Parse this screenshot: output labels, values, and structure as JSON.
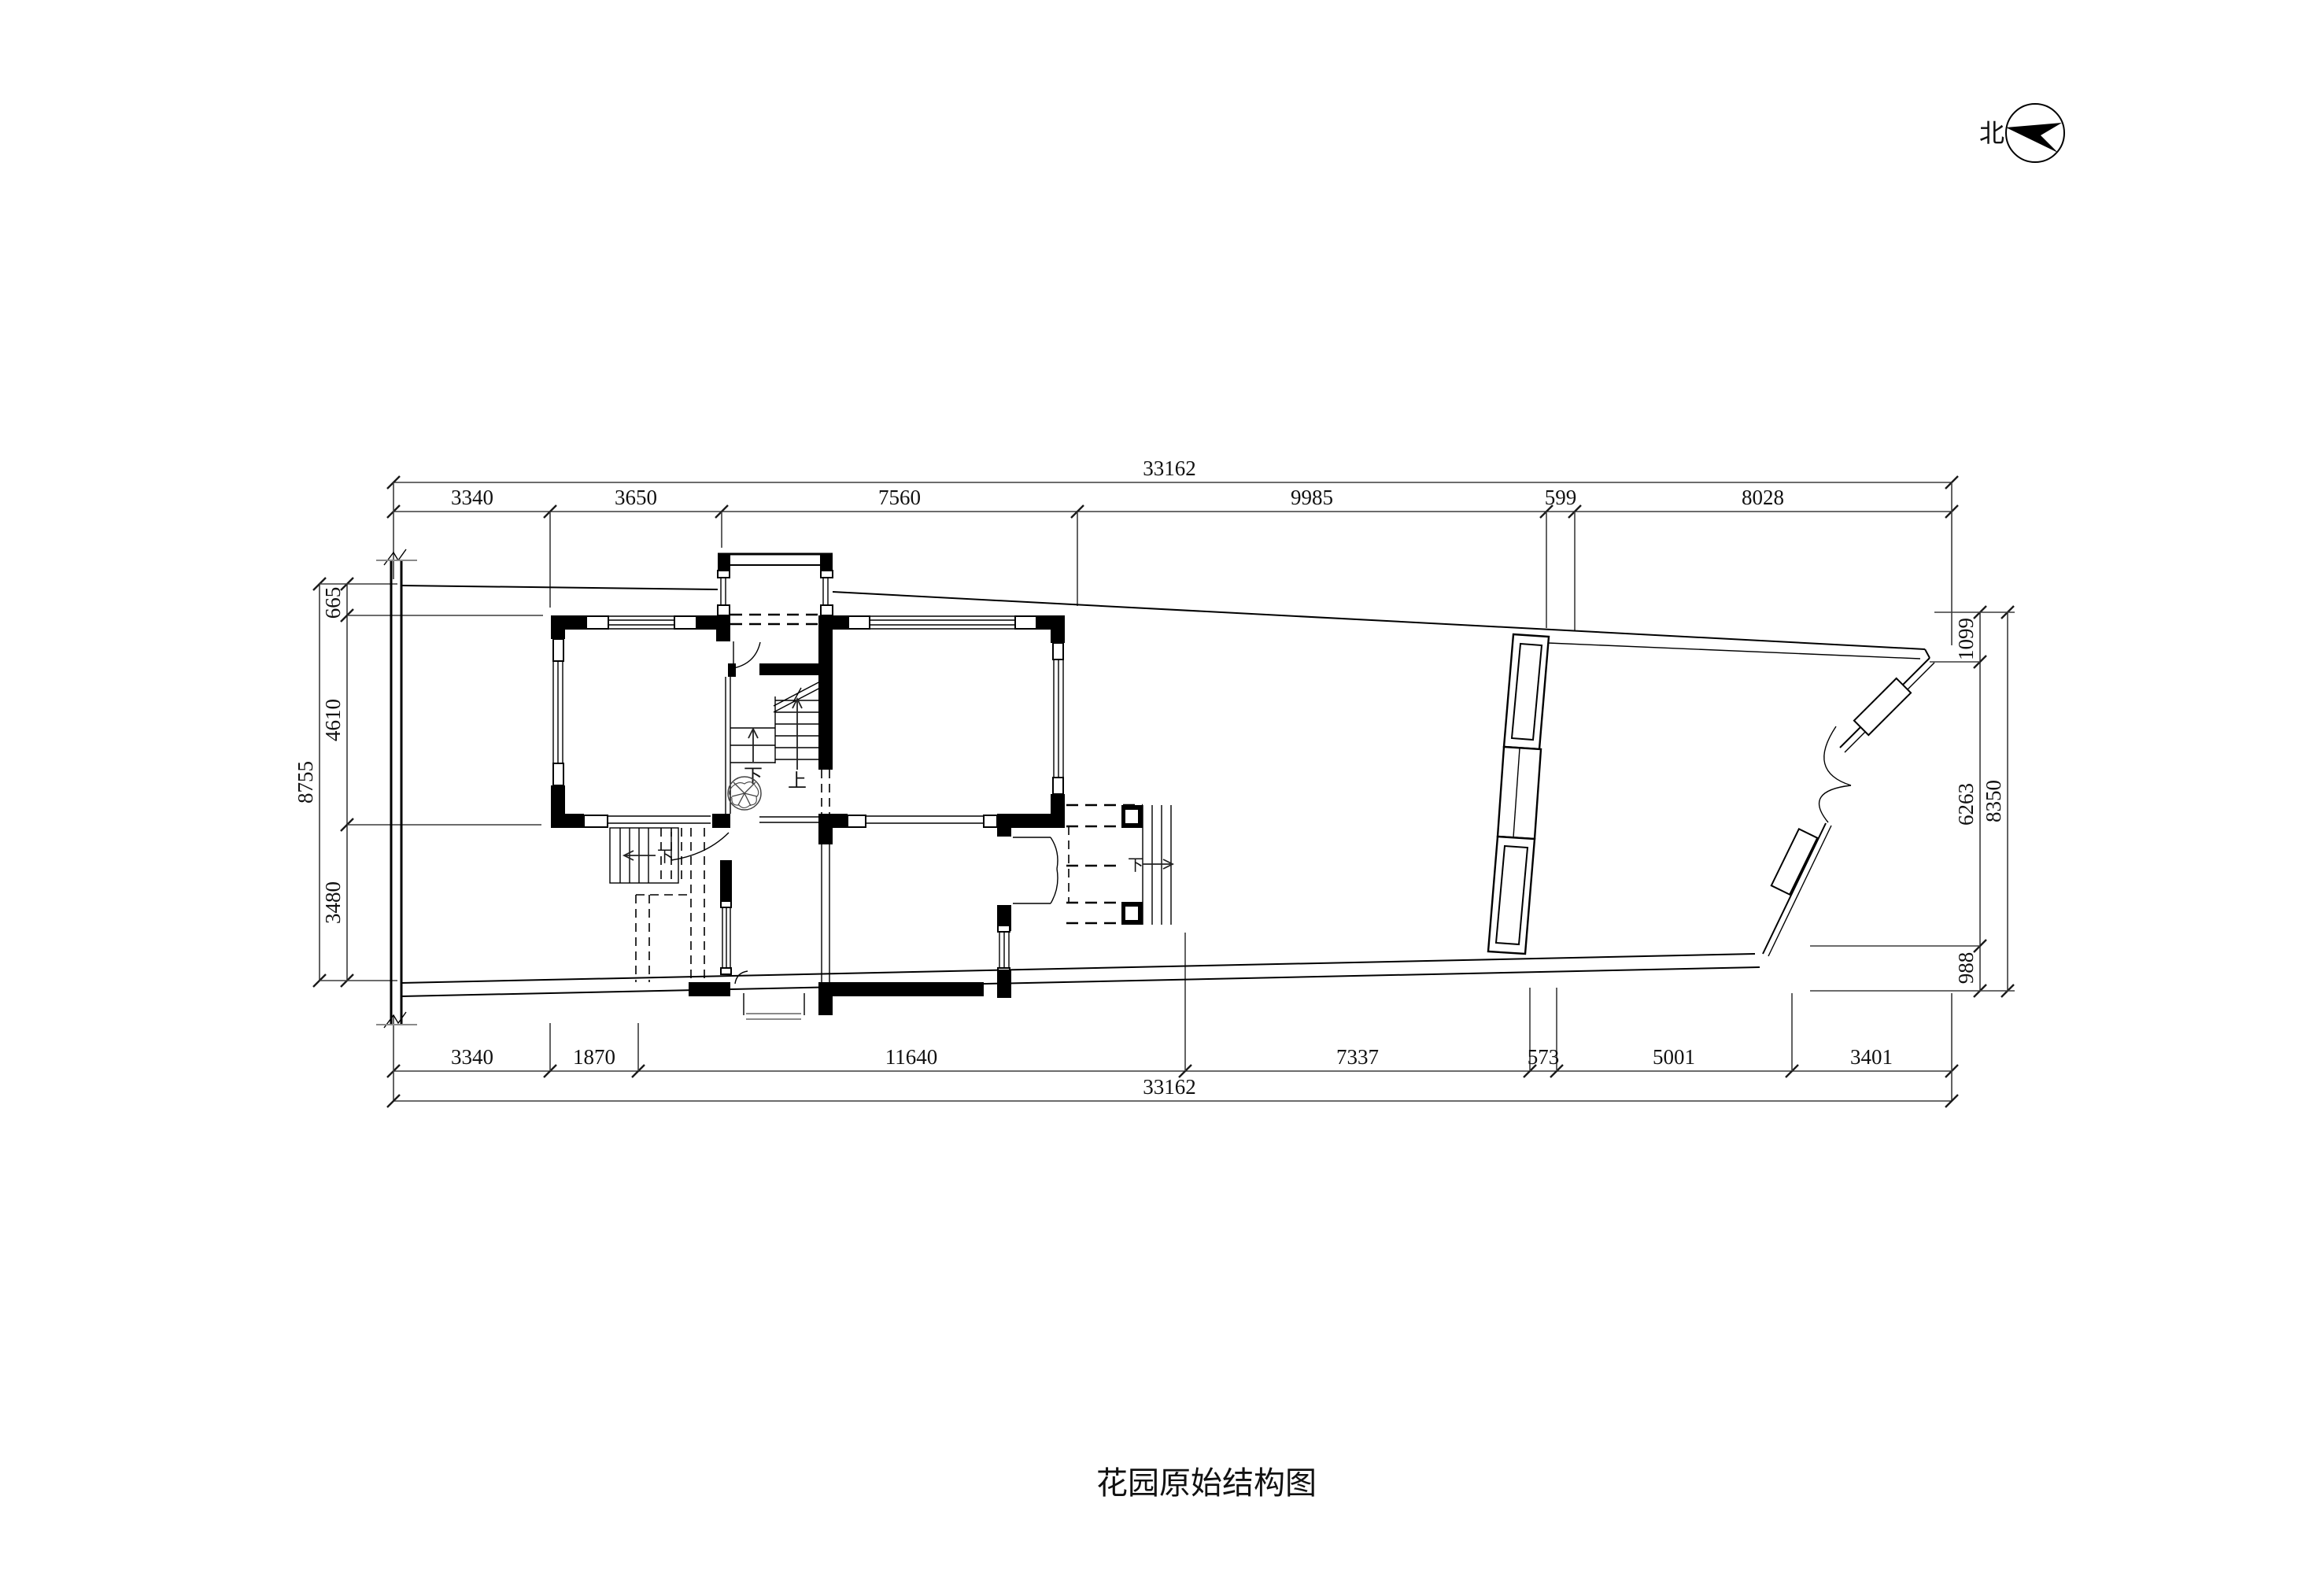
{
  "meta": {
    "title": "花园原始结构图",
    "north_label": "北"
  },
  "colors": {
    "background": "#ffffff",
    "line": "#000000",
    "dim_line": "#3c3c3c",
    "text": "#111111"
  },
  "dimensions": {
    "top": {
      "total": "33162",
      "segments": [
        "3340",
        "3650",
        "7560",
        "9985",
        "599",
        "8028"
      ]
    },
    "bottom": {
      "total": "33162",
      "segments": [
        "3340",
        "1870",
        "11640",
        "7337",
        "573",
        "5001",
        "3401"
      ]
    },
    "left": {
      "total": "8755",
      "segments": [
        "665",
        "4610",
        "3480"
      ]
    },
    "right": {
      "total": "8350",
      "segments": [
        "1099",
        "6263",
        "988"
      ]
    }
  },
  "annotations": {
    "stair_up": "上",
    "stair_down": "下",
    "basement_down": "下",
    "terrace_down": "下"
  }
}
